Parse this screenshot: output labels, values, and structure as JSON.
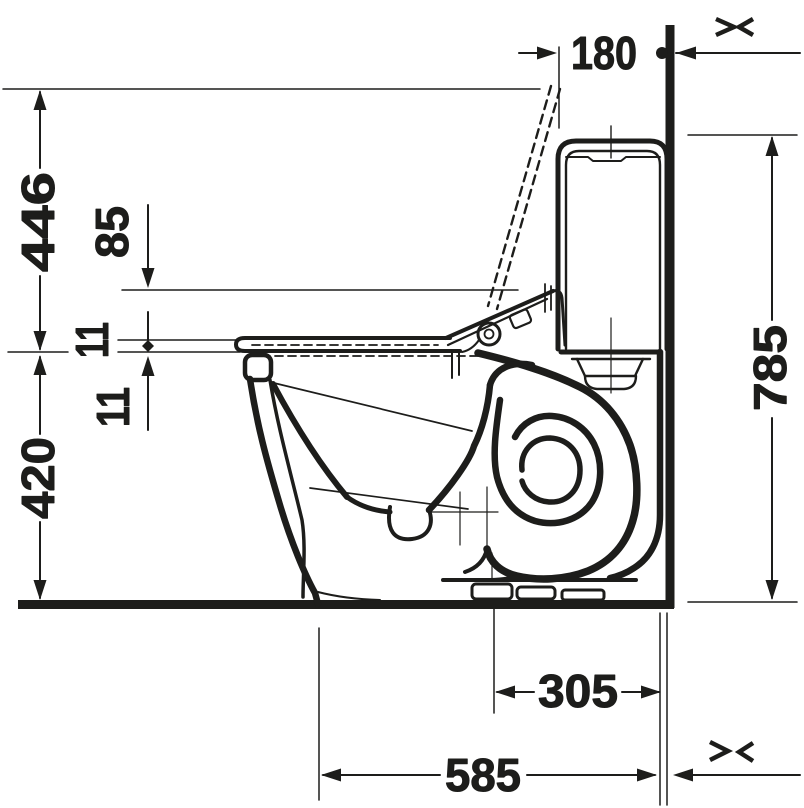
{
  "drawing": {
    "title": "toilet-side-elevation-dimension-drawing",
    "background": "#ffffff",
    "ink_color": "#1d1d1b",
    "dimensions": {
      "top": "180",
      "left_outer": "446",
      "left_inner": "85",
      "left_gap_upper": "11",
      "left_gap_lower": "11",
      "left_lower": "420",
      "right": "785",
      "bottom_inner": "305",
      "bottom_outer": "585"
    },
    "icons": {
      "top_right": "dimension-break-icon",
      "bottom_right": "dimension-break-icon"
    }
  }
}
